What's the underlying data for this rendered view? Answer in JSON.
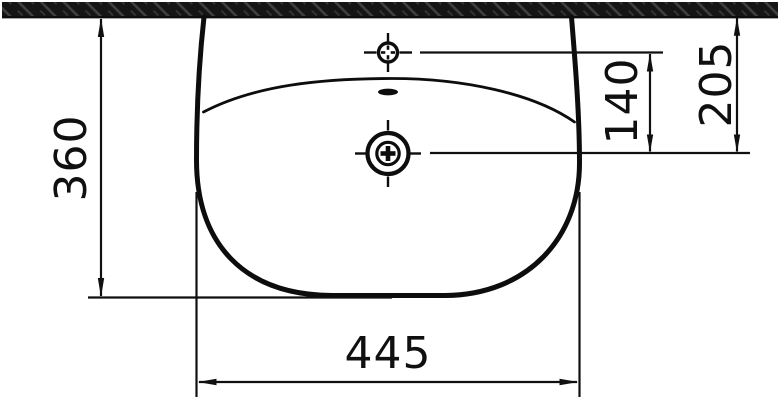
{
  "drawing": {
    "type": "technical-dimension-drawing",
    "view": "washbasin front elevation against wall",
    "dims": {
      "height": {
        "label": "360"
      },
      "width": {
        "label": "445"
      },
      "tap_to_drain": {
        "label": "140"
      },
      "wall_to_drain": {
        "label": "205"
      }
    },
    "symbols": {
      "wall": "wall-hatch-band",
      "tap_hole": "tap-hole-crosshair",
      "overflow": "overflow-slot",
      "drain": "drain-hole-crosshair"
    },
    "colors": {
      "line": "#101010",
      "wall_fill": "#151515",
      "wall_hatch": "#3f3f3f",
      "background": "#ffffff"
    }
  }
}
